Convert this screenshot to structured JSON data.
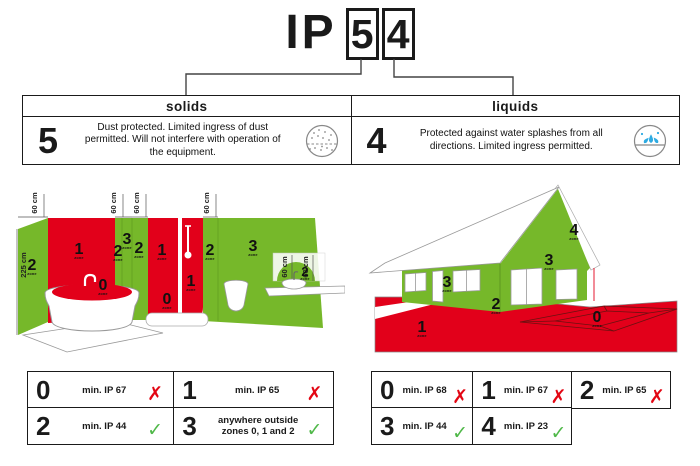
{
  "title": {
    "prefix": "IP",
    "solids_digit": "5",
    "liquids_digit": "4"
  },
  "rating_table": {
    "solids": {
      "header": "solids",
      "digit": "5",
      "description": "Dust protected. Limited ingress of dust permitted. Will not interfere with operation of the equipment.",
      "icon": "dust-particles-icon"
    },
    "liquids": {
      "header": "liquids",
      "digit": "4",
      "description": "Protected against water splashes from all directions. Limited ingress permitted.",
      "icon": "water-splash-icon"
    }
  },
  "bathroom": {
    "measurements": {
      "wall_height": "225 cm",
      "zone_width": "60 cm"
    },
    "zone_caption": "zone",
    "zone_labels": {
      "side_wall": "2",
      "tub_wall": "1",
      "strip_a": "2",
      "strip_b": "3",
      "strip_c": "2",
      "shower_left": "1",
      "shower_floor": "0",
      "shower_right": "1",
      "tub": "0",
      "strip_d": "2",
      "main_wall": "3",
      "basin": "2"
    }
  },
  "house": {
    "zone_caption": "zone",
    "zone_labels": {
      "ground": "1",
      "pit": "0",
      "base": "2",
      "front_wall": "3",
      "gable_wall": "3",
      "roof": "4"
    }
  },
  "bathroom_requirements": {
    "cells": [
      {
        "zone": "0",
        "text": "min. IP 67",
        "result": "fail",
        "mark": "✗"
      },
      {
        "zone": "1",
        "text": "min. IP 65",
        "result": "fail",
        "mark": "✗"
      },
      {
        "zone": "2",
        "text": "min. IP 44",
        "result": "pass",
        "mark": "✓"
      },
      {
        "zone": "3",
        "text": "anywhere outside zones 0, 1 and 2",
        "result": "pass",
        "mark": "✓"
      }
    ]
  },
  "house_requirements": {
    "cells": [
      {
        "zone": "0",
        "text": "min. IP 68",
        "result": "fail",
        "mark": "✗"
      },
      {
        "zone": "1",
        "text": "min. IP 67",
        "result": "fail",
        "mark": "✗"
      },
      {
        "zone": "2",
        "text": "min. IP 65",
        "result": "fail",
        "mark": "✗"
      },
      {
        "zone": "3",
        "text": "min. IP 44",
        "result": "pass",
        "mark": "✓"
      },
      {
        "zone": "4",
        "text": "min. IP 23",
        "result": "pass",
        "mark": "✓"
      }
    ]
  },
  "colors": {
    "zone_green": "#76b82a",
    "zone_red": "#e2001a",
    "pass_green": "#4fb848",
    "fail_red": "#e30613",
    "water_blue": "#2eabe2"
  }
}
